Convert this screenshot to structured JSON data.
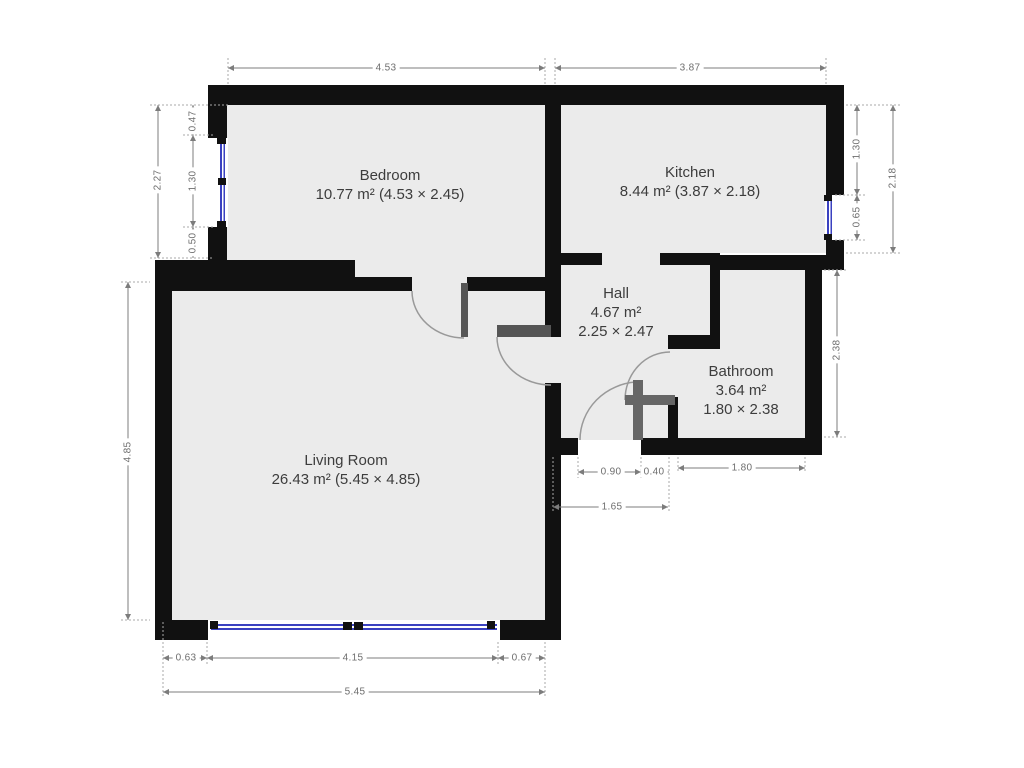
{
  "title": "Apartment floor plan",
  "rooms": [
    {
      "name": "Bedroom",
      "area": "10.77 m² (4.53 × 2.45)"
    },
    {
      "name": "Kitchen",
      "area": "8.44 m² (3.87 × 2.18)"
    },
    {
      "name": "Hall",
      "area": "4.67 m²",
      "size": "2.25 × 2.47"
    },
    {
      "name": "Bathroom",
      "area": "3.64 m²",
      "size": "1.80 × 2.38"
    },
    {
      "name": "Living Room",
      "area": "26.43 m² (5.45 × 4.85)"
    }
  ],
  "dims": {
    "bedroom_width": "4.53",
    "kitchen_width": "3.87",
    "left_outer": "2.27",
    "left_top": "0.47",
    "left_window": "1.30",
    "left_bottom": "0.50",
    "right_top": "1.30",
    "right_window": "0.65",
    "right_outer": "2.18",
    "bathroom_height": "2.38",
    "entrance_opening": "0.90",
    "entrance_pier": "0.40",
    "bathroom_width": "1.80",
    "hall_bottom": "1.65",
    "lr_left_offset": "0.63",
    "lr_window": "4.15",
    "lr_right_offset": "0.67",
    "lr_total_width": "5.45",
    "lr_height": "4.85"
  },
  "colors": {
    "wall": "#111111",
    "floor": "#ebebeb",
    "window_glass": "#3a41c0",
    "door_leaf": "#555555",
    "door_arc": "#999999",
    "dimension": "#7c7c7c",
    "room_text": "#3d3d3d",
    "background": "#ffffff"
  }
}
